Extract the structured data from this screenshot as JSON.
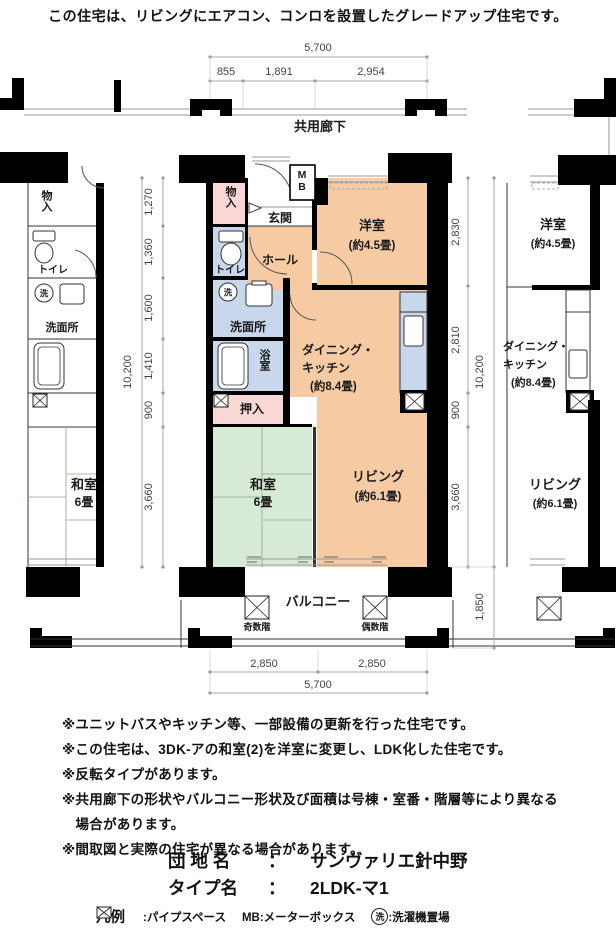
{
  "header": {
    "note": "この住宅は、リビングにエアコン、コンロを設置したグレードアップ住宅です。"
  },
  "corridor": {
    "label": "共用廊下"
  },
  "dims": {
    "top_total": "5,700",
    "top_segs": [
      "855",
      "1,891",
      "2,954"
    ],
    "bottom_total": "5,700",
    "bottom_segs": [
      "2,850",
      "2,850"
    ],
    "left_total": "10,200",
    "left_segs": [
      "1,270",
      "1,360",
      "1,600",
      "1,410",
      "900",
      "3,660"
    ],
    "right_total": "10,200",
    "right_segs": [
      "2,830",
      "2,810",
      "900",
      "3,660"
    ],
    "right_balcony": "1,850"
  },
  "unit": {
    "storage": "物入",
    "entrance": "玄関",
    "meter_box": "MB",
    "toilet": "トイレ",
    "hall": "ホール",
    "laundry": "洗",
    "washroom": "洗面所",
    "bath": "浴室",
    "closet": "押入",
    "western_name": "洋室",
    "western_size": "(約4.5畳)",
    "dk_line1": "ダイニング・",
    "dk_line2": "キッチン",
    "dk_size": "(約8.4畳)",
    "tatami_name": "和室",
    "tatami_size": "6畳",
    "living_name": "リビング",
    "living_size": "(約6.1畳)",
    "balcony": "バルコニー",
    "odd_floors": "奇数階",
    "even_floors": "偶数階"
  },
  "left_unit": {
    "storage": "物入",
    "toilet": "トイレ",
    "laundry": "洗",
    "washroom": "洗面所",
    "tatami_name": "和室",
    "tatami_size": "6畳"
  },
  "right_unit": {
    "western_name": "洋室",
    "western_size": "(約4.5畳)",
    "dk_line1": "ダイニング・",
    "dk_line2": "キッチン",
    "dk_size": "(約8.4畳)",
    "living_name": "リビング",
    "living_size": "(約6.1畳)"
  },
  "notes": [
    "※ユニットバスやキッチン等、一部設備の更新を行った住宅です。",
    "※この住宅は、3DK-アの和室(2)を洋室に変更し、LDK化した住宅です。",
    "※反転タイプがあります。",
    "※共用廊下の形状やバルコニー形状及び面積は号棟・室番・階層等により異なる場合があります。",
    "※間取図と実際の住宅が異なる場合があります。"
  ],
  "property": {
    "estate_label": "団 地 名",
    "estate_sep": "：",
    "estate_value": "サンヴァリエ針中野",
    "type_label": "タイプ名",
    "type_sep": "：",
    "type_value": "2LDK-マ1"
  },
  "legend": {
    "title": "凡例",
    "pipe_space": ":パイプスペース",
    "meter_box": "MB:メーターボックス",
    "laundry_sym": "洗",
    "laundry": ":洗濯機置場"
  },
  "colors": {
    "room_peach": "#F6CBA4",
    "room_pink": "#F8D7D5",
    "room_blue": "#C9D7EC",
    "room_green": "#D7EAD5"
  }
}
